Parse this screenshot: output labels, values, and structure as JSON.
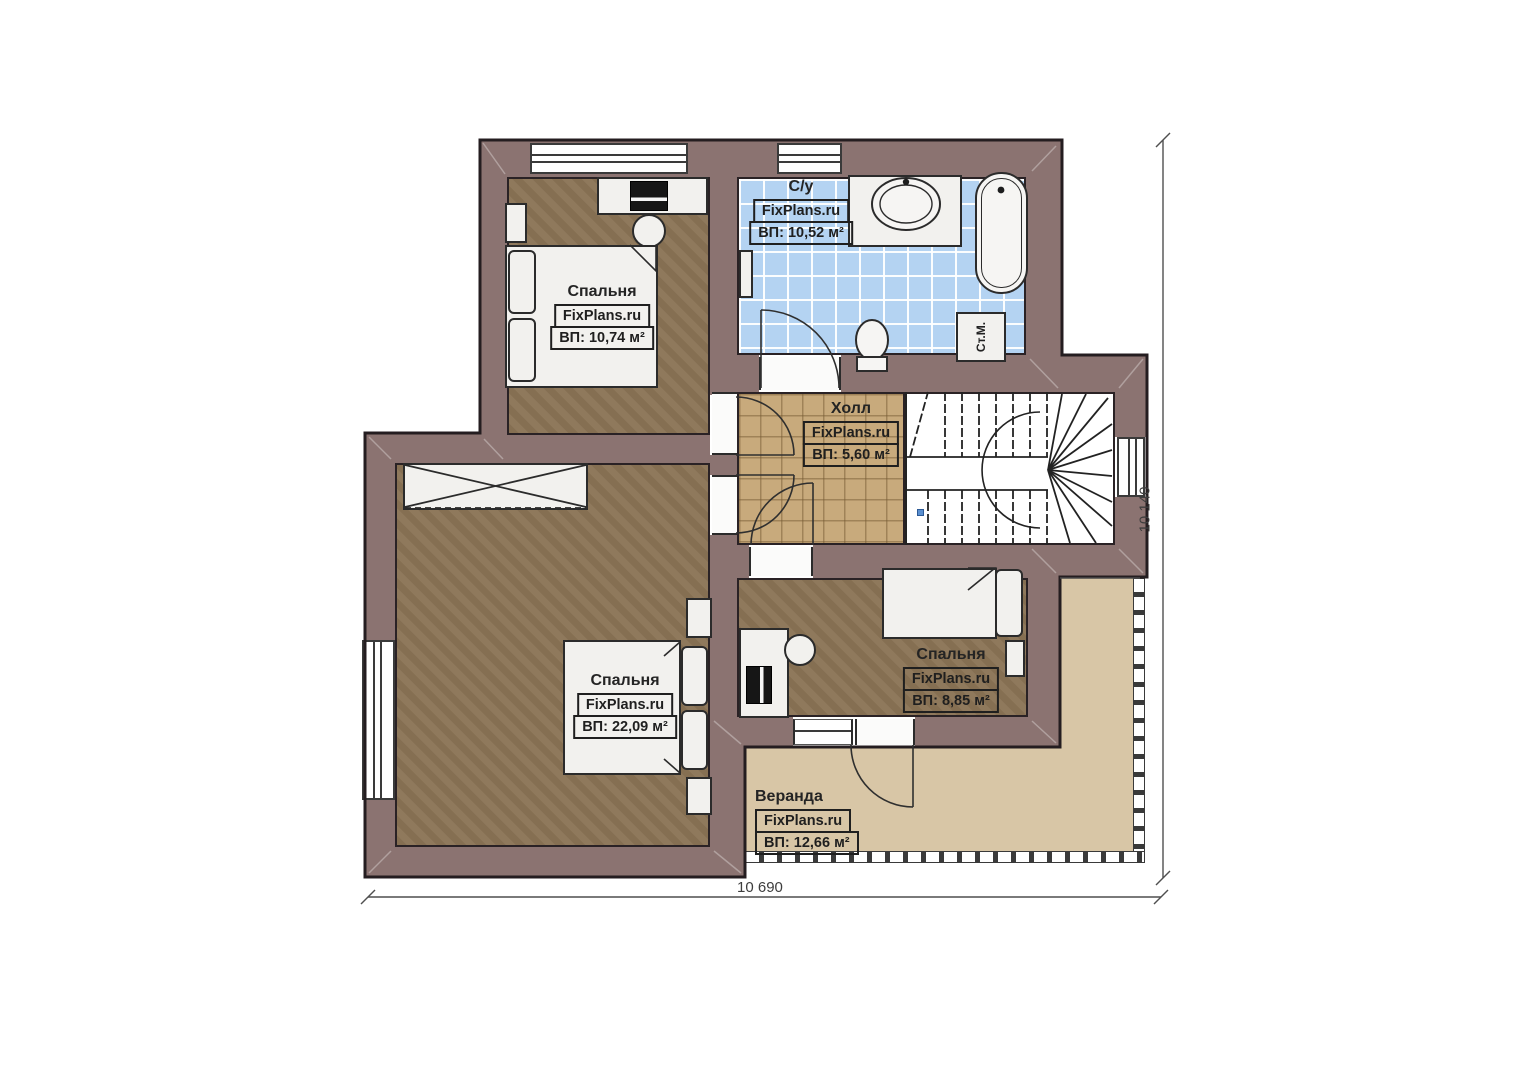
{
  "plan": {
    "brand": "FixPlans.ru",
    "rooms": {
      "bedroom_tl": {
        "name": "Спальня",
        "area": "ВП: 10,74 м²"
      },
      "bathroom": {
        "name": "С/у",
        "area": "ВП: 10,52 м²"
      },
      "hall": {
        "name": "Холл",
        "area": "ВП: 5,60 м²"
      },
      "bedroom_big": {
        "name": "Спальня",
        "area": "ВП: 22,09 м²"
      },
      "bedroom_right": {
        "name": "Спальня",
        "area": "ВП: 8,85 м²"
      },
      "veranda": {
        "name": "Веранда",
        "area": "ВП: 12,66 м²"
      }
    },
    "appliances": {
      "washing_machine": "Ст.М."
    },
    "dimensions": {
      "width_bottom": "10 690",
      "height_right": "10 140"
    },
    "colors": {
      "wall": "#8b7371",
      "bedroom_floor": "#8b7456",
      "hall_tile": "#c8aa7c",
      "bathroom_tile": "#b4d3f2",
      "veranda_floor": "#d8c6a6",
      "outline": "#241d20",
      "stair_accent": "#5a8fd0"
    }
  }
}
